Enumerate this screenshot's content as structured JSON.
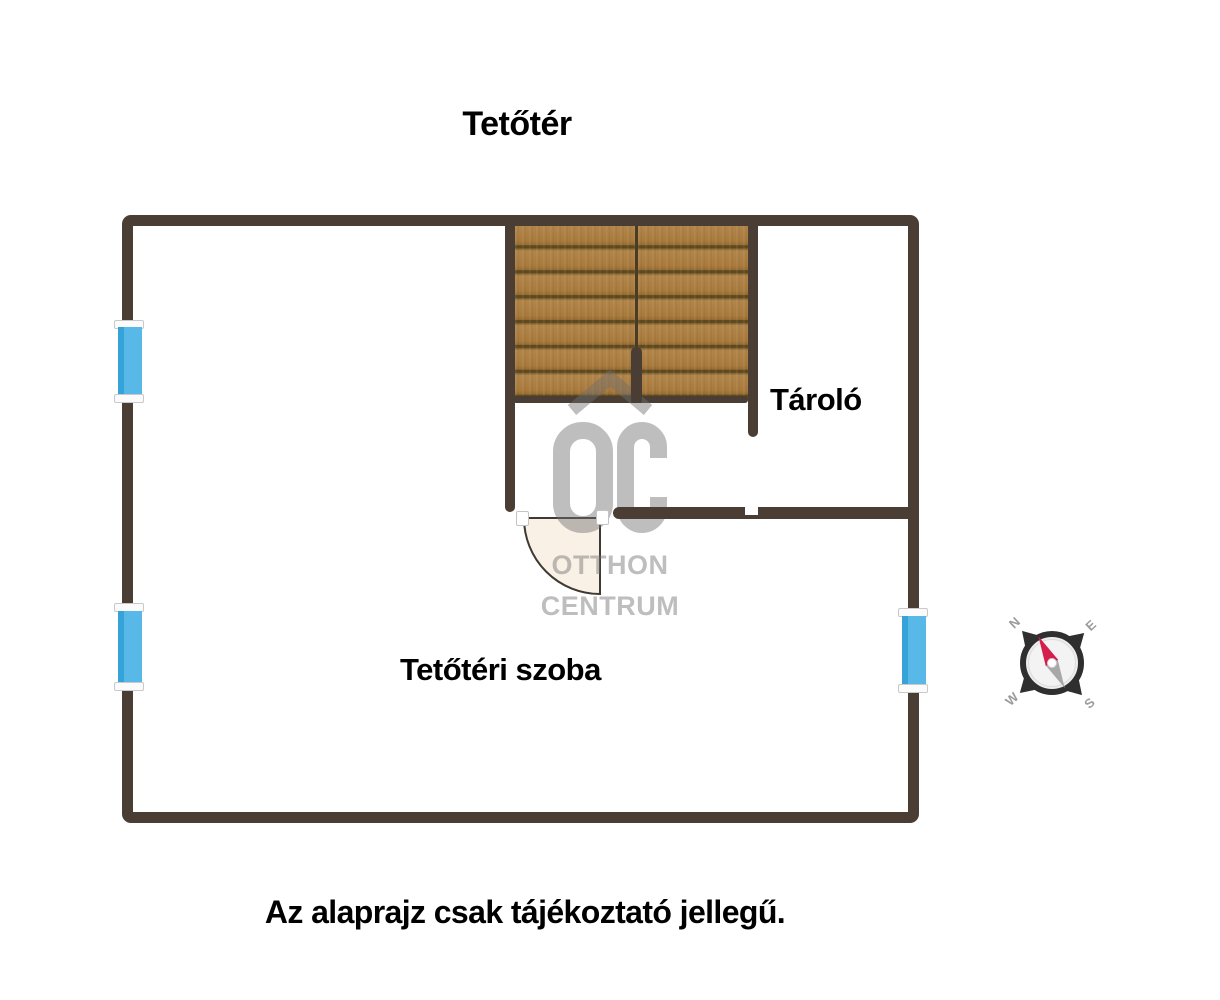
{
  "title": "Tetőtér",
  "rooms": {
    "storage": "Tároló",
    "attic_room": "Tetőtéri szoba"
  },
  "watermark": {
    "logo": "OC",
    "line1": "OTTHON",
    "line2": "CENTRUM"
  },
  "disclaimer": "Az alaprajz csak tájékoztató jellegű.",
  "compass": {
    "n": "N",
    "e": "E",
    "s": "S",
    "w": "W"
  },
  "colors": {
    "wall": "#4a3e34",
    "wood": "#a87a3c",
    "wood_light": "#b2854a",
    "wood_line": "#5f4a20",
    "window_glass": "#58b8e7",
    "window_glass_dark": "#36a3d8",
    "door_leaf": "#f9f1e6",
    "watermark_gray": "rgba(110,110,110,0.45)",
    "needle_red": "#d41f4d",
    "compass_ring": "#2f2f2f",
    "label_black": "#000000"
  }
}
